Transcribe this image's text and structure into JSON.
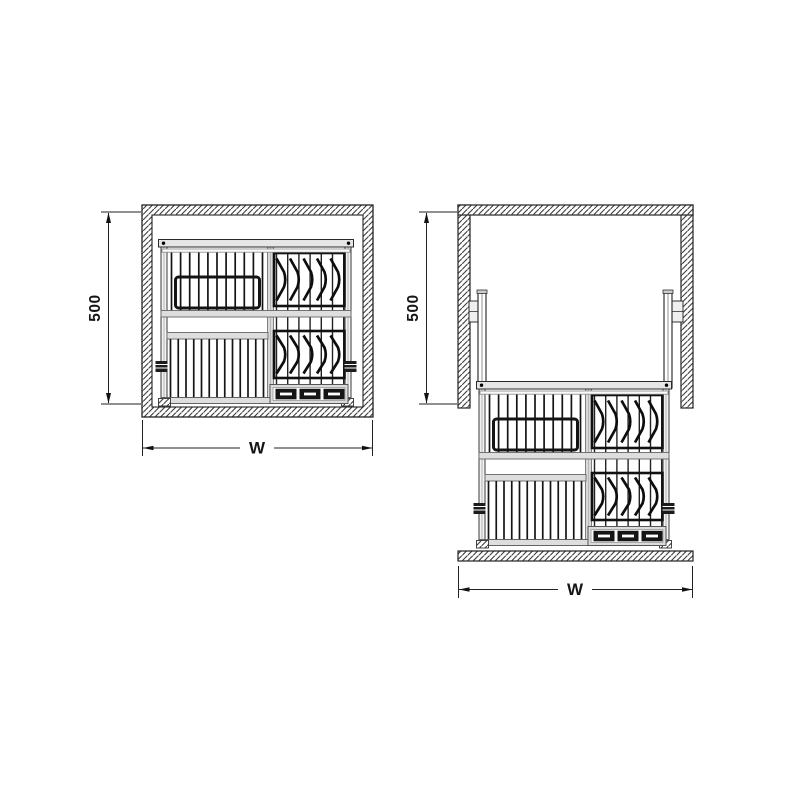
{
  "diagram": {
    "type": "technical-drawing",
    "subject": "Pull-down dish rack in wall cabinet, closed and lowered positions",
    "colors": {
      "background": "#ffffff",
      "line": "#2b2b2b",
      "heavy_line": "#111111",
      "hatch_line": "#3c3c3c",
      "rail_fill": "#dedede",
      "tray_slot_fill": "#151515"
    },
    "views": [
      {
        "id": "closed-position",
        "height_dimension": "500",
        "width_dimension": "W"
      },
      {
        "id": "open-position",
        "height_dimension": "500",
        "width_dimension": "W"
      }
    ]
  }
}
